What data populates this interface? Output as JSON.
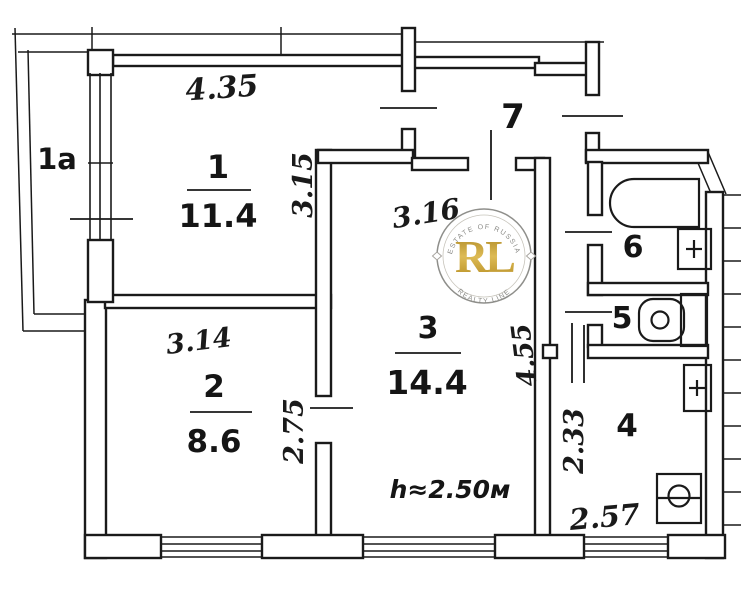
{
  "plan": {
    "rooms": {
      "balcony": {
        "number": "1a"
      },
      "room1": {
        "number": "1",
        "area": "11.4",
        "width": "4.35",
        "depth": "3.15"
      },
      "room2": {
        "number": "2",
        "area": "8.6",
        "width": "3.14",
        "depth": "2.75"
      },
      "room3": {
        "number": "3",
        "area": "14.4",
        "width": "3.16",
        "depth": "4.55",
        "ceiling": "h≈2.50м"
      },
      "kitchen": {
        "number": "4",
        "width": "2.57",
        "depth": "2.33"
      },
      "toilet": {
        "number": "5"
      },
      "bathroom": {
        "number": "6"
      },
      "hallway": {
        "number": "7"
      }
    },
    "watermark": {
      "initials": "RL",
      "arc_top": "ESTATE OF RUSSIA",
      "arc_bottom": "REALTY LINE"
    },
    "colors": {
      "ink": "#1a1a1a",
      "gold": "#c2992e"
    }
  }
}
